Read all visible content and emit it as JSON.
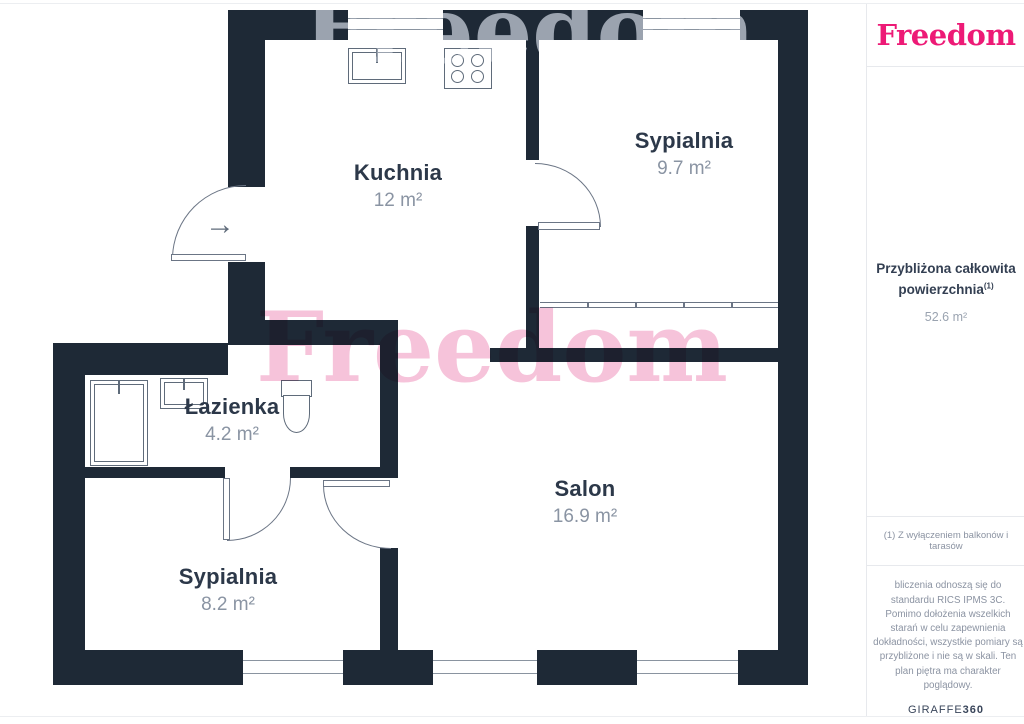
{
  "colors": {
    "wall": "#1e2936",
    "brand_pink": "#ed1a76",
    "watermark_pink": "#f5bdd6",
    "watermark_gray": "#9ba3af"
  },
  "watermark": {
    "text": "Freedom"
  },
  "icons": {
    "entrance_arrow": "→"
  },
  "rooms": [
    {
      "name": "Kuchnia",
      "area": "12 m²"
    },
    {
      "name": "Sypialnia",
      "area": "9.7 m²"
    },
    {
      "name": "Łazienka",
      "area": "4.2 m²"
    },
    {
      "name": "Salon",
      "area": "16.9 m²"
    },
    {
      "name": "Sypialnia",
      "area": "8.2 m²"
    }
  ],
  "sidebar": {
    "logo": "Freedom",
    "total_label_line1": "Przybliżona całkowita",
    "total_label_line2": "powierzchnia",
    "total_footnote_marker": "(1)",
    "total_value": "52.6 m²",
    "footnote": "(1) Z wyłączeniem balkonów i tarasów",
    "disclaimer": "bliczenia odnoszą się do standardu RICS IPMS 3C. Pomimo dołożenia wszelkich starań w celu zapewnienia dokładności, wszystkie pomiary są przybliżone i nie są w skali. Ten plan piętra ma charakter poglądowy.",
    "provider": "GIRAFFE",
    "provider_suffix": "360"
  }
}
